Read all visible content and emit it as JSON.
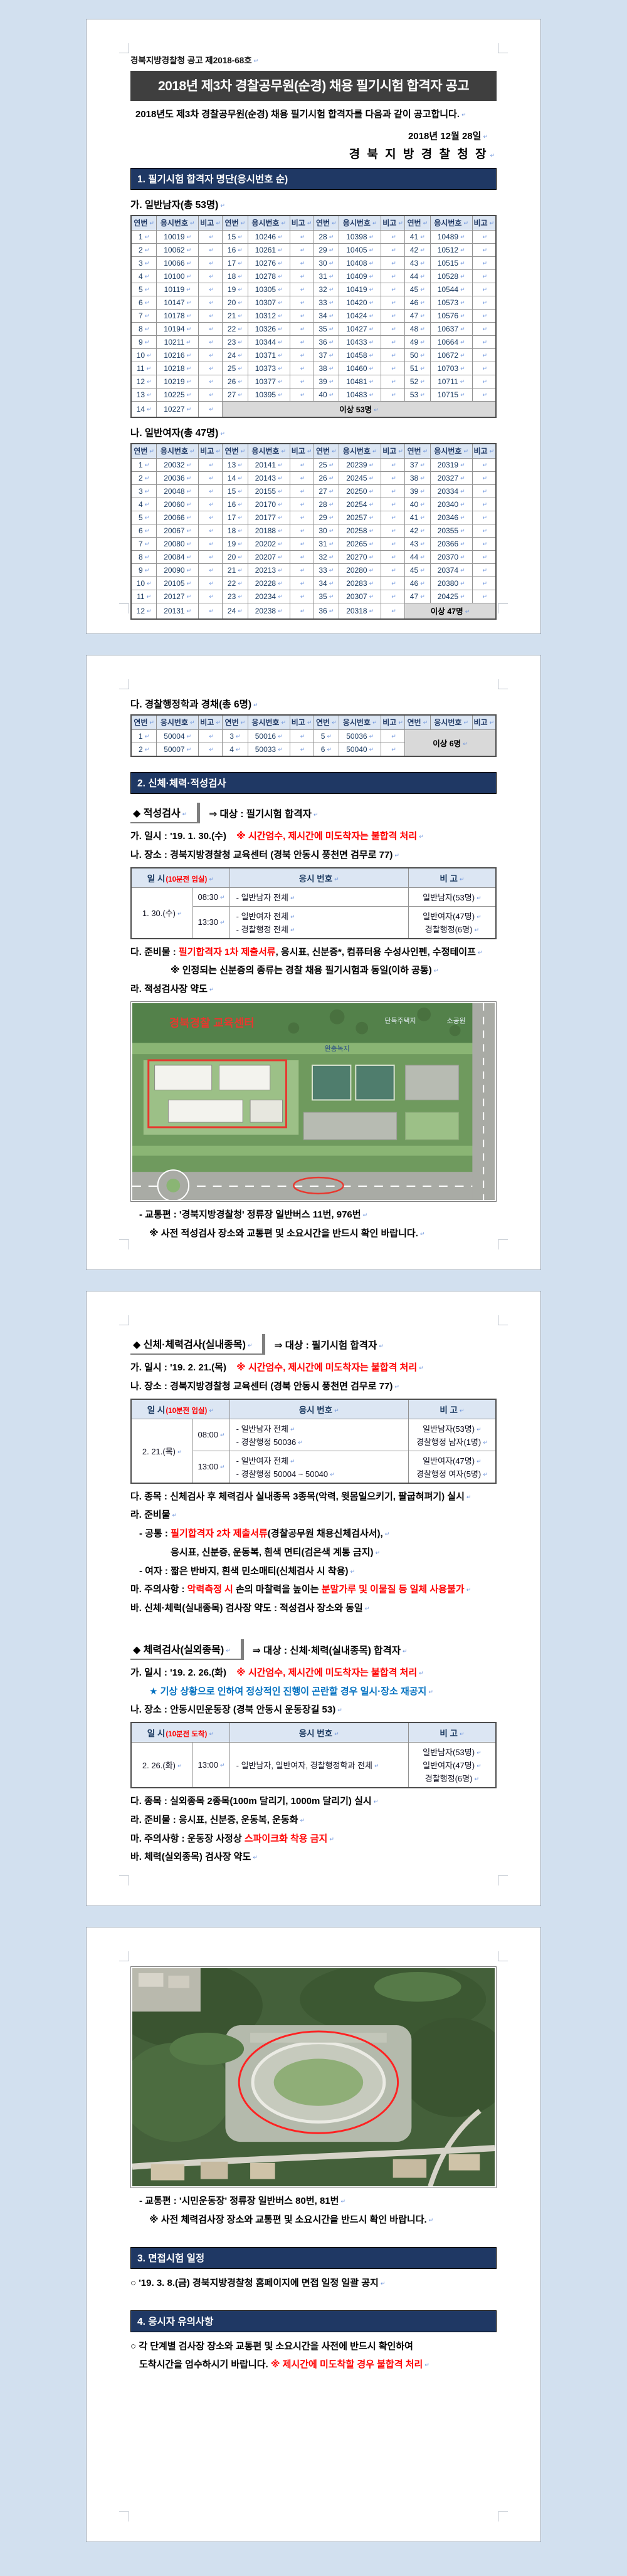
{
  "doc_header": {
    "notice_no": "경북지방경찰청 공고 제2018-68호",
    "title": "2018년 제3차 경찰공무원(순경) 채용 필기시험 합격자 공고",
    "intro": "2018년도 제3차 경찰공무원(순경) 채용 필기시험 합격자를 다음과 같이 공고합니다.",
    "date": "2018년  12월  28일",
    "signer": "경 북 지 방 경 찰 청 장"
  },
  "section1_bar": "1. 필기시험 합격자 명단(응시번호 순)",
  "roster_headers": [
    "연번",
    "응시번호",
    "비고"
  ],
  "rosters": [
    {
      "title": "가. 일반남자(총 53명)",
      "footer": "이상 53명",
      "sizes": [
        14,
        13,
        13,
        13
      ],
      "numbers": [
        10019,
        10062,
        10066,
        10100,
        10119,
        10147,
        10178,
        10194,
        10211,
        10216,
        10218,
        10219,
        10225,
        10227,
        10246,
        10261,
        10276,
        10278,
        10305,
        10307,
        10312,
        10326,
        10344,
        10371,
        10373,
        10377,
        10395,
        10398,
        10405,
        10408,
        10409,
        10419,
        10420,
        10424,
        10427,
        10433,
        10458,
        10460,
        10481,
        10483,
        10489,
        10512,
        10515,
        10528,
        10544,
        10573,
        10576,
        10637,
        10664,
        10672,
        10703,
        10711,
        10715
      ]
    },
    {
      "title": "나. 일반여자(총 47명)",
      "footer": "이상 47명",
      "sizes": [
        12,
        12,
        12,
        11
      ],
      "numbers": [
        20032,
        20036,
        20048,
        20060,
        20066,
        20067,
        20080,
        20084,
        20090,
        20105,
        20127,
        20131,
        20141,
        20143,
        20155,
        20170,
        20177,
        20188,
        20202,
        20207,
        20213,
        20228,
        20234,
        20238,
        20239,
        20245,
        20250,
        20254,
        20257,
        20258,
        20265,
        20270,
        20280,
        20283,
        20307,
        20318,
        20319,
        20327,
        20334,
        20340,
        20346,
        20355,
        20366,
        20370,
        20374,
        20380,
        20425
      ]
    },
    {
      "title": "다. 경찰행정학과 경채(총 6명)",
      "footer": "이상 6명",
      "sizes": [
        2,
        2,
        2,
        0
      ],
      "numbers": [
        50004,
        50007,
        50016,
        50033,
        50036,
        50040
      ]
    }
  ],
  "section2_bar": "2. 신체·체력·적성검사",
  "common": {
    "time_warn": "※ 시간엄수, 제시간에 미도착자는 불합격 처리"
  },
  "aptitude": {
    "label": "◆ 적성검사",
    "target": "⇒ 대상 : 필기시험 합격자",
    "when_black": "가. 일시 : '19. 1. 30.(수)",
    "where": "나. 장소 : 경북지방경찰청 교육센터 (경북 안동시 풍천면 검무로 77)",
    "table": {
      "h_date": "일 시",
      "h_date_note": "(10분전 입실)",
      "h_num": "응시 번호",
      "h_note": "비 고",
      "date": "1. 30.(수)",
      "slots": [
        {
          "time": "08:30",
          "nums": [
            "- 일반남자 전체"
          ],
          "notes": [
            "일반남자(53명)"
          ]
        },
        {
          "time": "13:30",
          "nums": [
            "- 일반여자 전체",
            "- 경찰행정 전체"
          ],
          "notes": [
            "일반여자(47명)",
            "경찰행정(6명)"
          ]
        }
      ]
    },
    "items_label": "다. 준비물 : ",
    "items_red": "필기합격자 1차 제출서류",
    "items_rest": ", 응시표, 신분증*, 컴퓨터용 수성사인펜, 수정테이프",
    "id_note": "※ 인정되는 신분증의 종류는 경찰 채용 필기시험과 동일(이하 공통)",
    "map_label": "라. 적성검사장 약도",
    "transport": "- 교통편 : '경북지방경찰청' 정류장 일반버스 11번, 976번",
    "confirm_note": "※ 사전 적성검사 장소와 교통편 및 소요시간을 반드시 확인 바랍니다."
  },
  "map1": {
    "center_label": "경북경찰 교육센터",
    "label_housing": "단독주택지",
    "label_park": "소공원",
    "label_buffer": "완충녹지"
  },
  "indoor": {
    "label": "◆ 신체·체력검사(실내종목)",
    "target": "⇒ 대상 : 필기시험 합격자",
    "when_black": "가. 일시 : '19. 2. 21.(목)",
    "where": "나. 장소 : 경북지방경찰청 교육센터 (경북 안동시 풍천면 검무로 77)",
    "table": {
      "h_date": "일 시",
      "h_date_note": "(10분전 입실)",
      "h_num": "응시 번호",
      "h_note": "비 고",
      "date": "2. 21.(목)",
      "slots": [
        {
          "time": "08:00",
          "nums": [
            "- 일반남자 전체",
            "- 경찰행정 50036"
          ],
          "notes": [
            "일반남자(53명)",
            "경찰행정 남자(1명)"
          ]
        },
        {
          "time": "13:00",
          "nums": [
            "- 일반여자 전체",
            "- 경찰행정 50004 ~ 50040"
          ],
          "notes": [
            "일반여자(47명)",
            "경찰행정 여자(5명)"
          ]
        }
      ]
    },
    "events": "다. 종목 : 신체검사 후 체력검사 실내종목 3종목(악력, 윗몸일으키기, 팔굽혀펴기) 실시",
    "items_label": "라. 준비물",
    "common_label": "- 공통 : ",
    "common_red": "필기합격자 2차 제출서류",
    "common_rest": "(경찰공무원 채용신체검사서),",
    "common_line2": "응시표, 신분증, 운동복, 흰색 면티(검은색 계통 금지)",
    "female_line": "- 여자 : 짧은 반바지, 흰색 민소매티(신체검사 시 착용)",
    "caution_label": "마. 주의사항 : ",
    "caution_red1": "악력측정 시",
    "caution_mid": " 손의 마찰력을 높이는 ",
    "caution_red2": "분말가루 및 이물질 등 일체 사용불가",
    "map_line": "바. 신체·체력(실내종목) 검사장 약도 : 적성검사 장소와 동일"
  },
  "outdoor": {
    "label": "◆ 체력검사(실외종목)",
    "target": "⇒ 대상 : 신체·체력(실내종목) 합격자",
    "when_black": "가. 일시 : '19. 2. 26.(화)",
    "weather_note": "★ 기상 상황으로 인하여 정상적인 진행이 곤란할 경우 일시·장소 재공지",
    "where": "나. 장소 : 안동시민운동장 (경북 안동시 운동장길 53)",
    "table": {
      "h_date": "일 시",
      "h_date_note": "(10분전 도착)",
      "h_num": "응시 번호",
      "h_note": "비 고",
      "date": "2. 26.(화)",
      "slots": [
        {
          "time": "13:00",
          "nums": [
            "- 일반남자, 일반여자, 경찰행정학과 전체"
          ],
          "notes": [
            "일반남자(53명)",
            "일반여자(47명)",
            "경찰행정(6명)"
          ]
        }
      ]
    },
    "events": "다. 종목 : 실외종목 2종목(100m 달리기, 1000m 달리기) 실시",
    "items": "라. 준비물 : 응시표, 신분증, 운동복, 운동화",
    "caution_label": "마. 주의사항 : 운동장 사정상 ",
    "caution_red": "스파이크화 착용 금지",
    "map_label": "바. 체력(실외종목) 검사장 약도",
    "transport": "- 교통편 : '시민운동장' 정류장 일반버스 80번, 81번",
    "confirm_note": "※ 사전 체력검사장 장소와 교통편 및 소요시간을 반드시 확인 바랍니다."
  },
  "interview": {
    "bar": "3. 면접시험 일정",
    "line": "○ '19. 3. 8.(금) 경북지방경찰청 홈페이지에 면접 일정 일괄 공지"
  },
  "notices": {
    "bar": "4. 응시자 유의사항",
    "line1": "○ 각 단계별 검사장 장소와 교통편 및 소요시간을 사전에 반드시 확인하여",
    "line2": "도착시간을 엄수하시기 바랍니다. ",
    "line2_red": "※ 제시간에 미도착할 경우 불합격 처리"
  }
}
